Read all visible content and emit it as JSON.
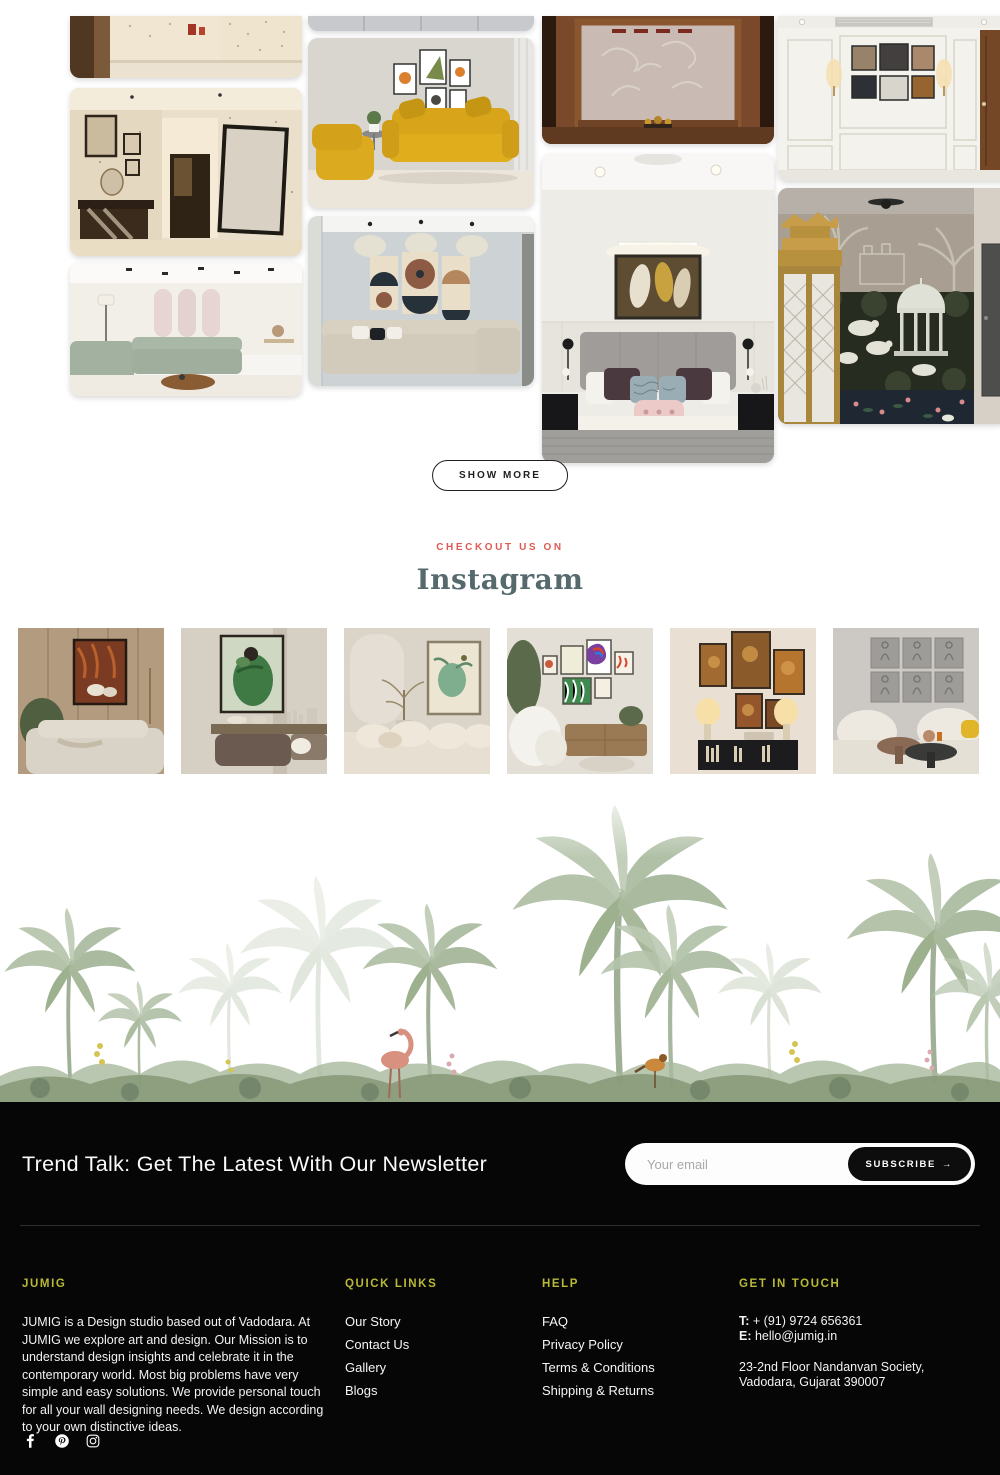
{
  "gallery": {
    "show_more_label": "SHOW MORE",
    "photos": [
      {
        "name": "foyer-patterned-wall"
      },
      {
        "name": "hallway-dotted-wallpaper"
      },
      {
        "name": "living-room-arches-sage-sofa"
      },
      {
        "name": "grey-panel-headboard"
      },
      {
        "name": "yellow-leather-sofa-living-room"
      },
      {
        "name": "geometric-circle-art-living-room"
      },
      {
        "name": "wooden-pooja-mandir"
      },
      {
        "name": "bedroom-grey-bed-gold-art"
      },
      {
        "name": "white-wainscot-gallery-wall"
      },
      {
        "name": "pichwai-mural-room-golden-mandir"
      }
    ]
  },
  "instagram": {
    "kicker": "CHECKOUT US ON",
    "title": "Instagram",
    "thumbnails": [
      {
        "name": "wood-wall-orange-art-sofa"
      },
      {
        "name": "green-figure-art-console"
      },
      {
        "name": "arch-wall-botanical-art-sofa"
      },
      {
        "name": "colorful-gallery-wall-armchair"
      },
      {
        "name": "warm-art-cluster-lamps-console"
      },
      {
        "name": "grey-relief-panels-cream-sofas"
      }
    ]
  },
  "newsletter": {
    "title": "Trend Talk: Get The Latest With Our Newsletter",
    "email_placeholder": "Your email",
    "subscribe_label": "SUBSCRIBE",
    "subscribe_arrow": "→"
  },
  "footer": {
    "about": {
      "heading": "JUMIG",
      "text": "JUMIG is a Design studio based out of Vadodara. At JUMIG we explore art and design. Our Mission is to understand design insights and celebrate it in the contemporary world. Most big problems have very simple and easy solutions. We provide personal touch for all your wall designing needs. We design according to your own distinctive ideas."
    },
    "quick_links": {
      "heading": "QUICK LINKS",
      "items": [
        "Our Story",
        "Contact Us",
        "Gallery",
        "Blogs"
      ]
    },
    "help": {
      "heading": "HELP",
      "items": [
        "FAQ",
        "Privacy Policy",
        "Terms & Conditions",
        "Shipping & Returns"
      ]
    },
    "contact": {
      "heading": "GET IN TOUCH",
      "phone_label": "T:",
      "phone": " + (91) 9724 656361",
      "email_label": "E:",
      "email": " hello@jumig.in",
      "address_line1": "23-2nd Floor Nandanvan Society,",
      "address_line2": "Vadodara, Gujarat 390007"
    },
    "social": [
      "facebook",
      "pinterest",
      "instagram"
    ]
  },
  "colors": {
    "kicker_red": "#e05a54",
    "instagram_title": "#566a6d",
    "footer_heading_yellow": "#b8b937",
    "footer_bg": "#060606"
  }
}
